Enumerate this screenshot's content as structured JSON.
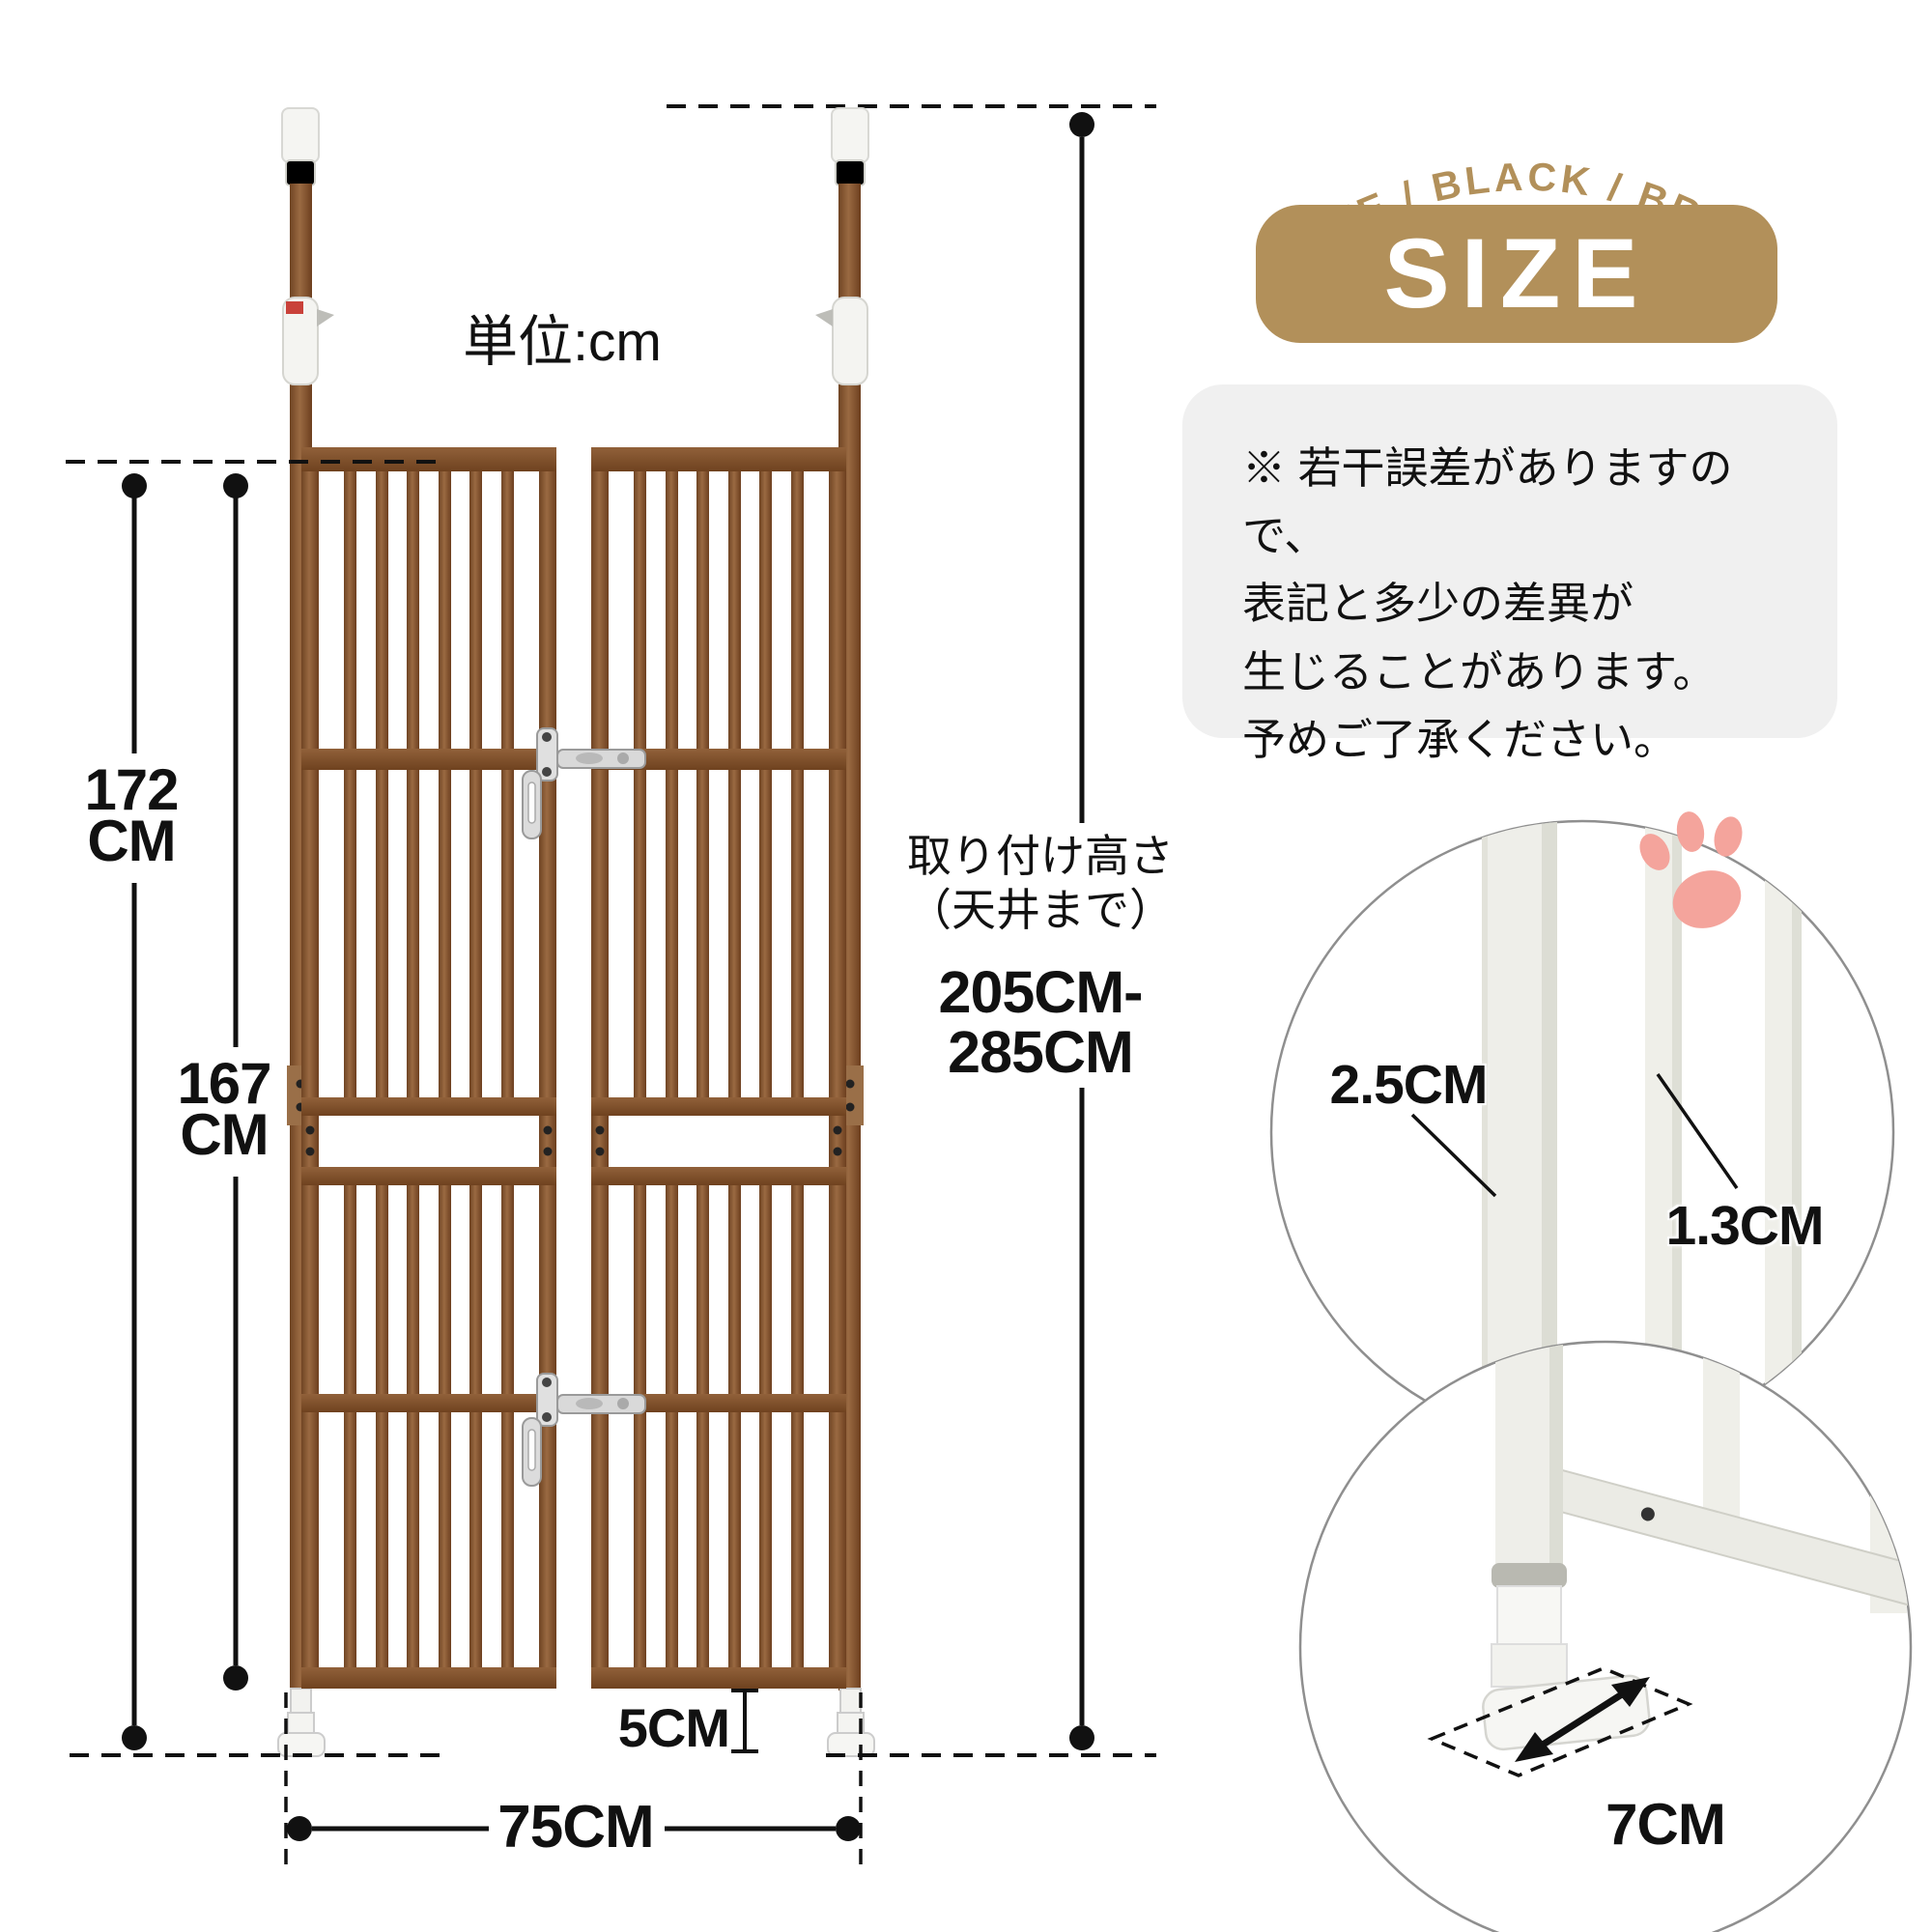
{
  "diagram": {
    "unit_label": "単位:cm",
    "dim_height_outer": {
      "value": "172",
      "unit": "CM"
    },
    "dim_height_panel": {
      "value": "167",
      "unit": "CM"
    },
    "dim_mount": {
      "label_line1": "取り付け高さ",
      "label_line2": "（天井まで）",
      "value_line1": "205CM-",
      "value_line2": "285CM"
    },
    "dim_gap_bottom": "5CM",
    "dim_width": "75CM"
  },
  "side": {
    "color_options": "WHITE / BLACK / BROWN",
    "size_badge": "SIZE",
    "note_lines": [
      "※ 若干誤差がありますので、",
      "表記と多少の差異が",
      "生じることがあります。",
      "予めご了承ください。"
    ],
    "detail_top": {
      "pole_diameter": "2.5CM",
      "bar_diameter": "1.3CM"
    },
    "detail_bottom": {
      "foot_depth": "7CM"
    }
  },
  "icons": {
    "paw": "paw-print-icon"
  },
  "colors": {
    "accent_gold": "#b2905a",
    "gate_brown": "#8a5733",
    "gate_brown_dark": "#6d3f1f",
    "paw_pink": "#f4a49c",
    "note_bg": "#f0f0f0",
    "ink": "#111111",
    "metal_silver": "#d6d6d6",
    "white_product": "#efefe9"
  }
}
